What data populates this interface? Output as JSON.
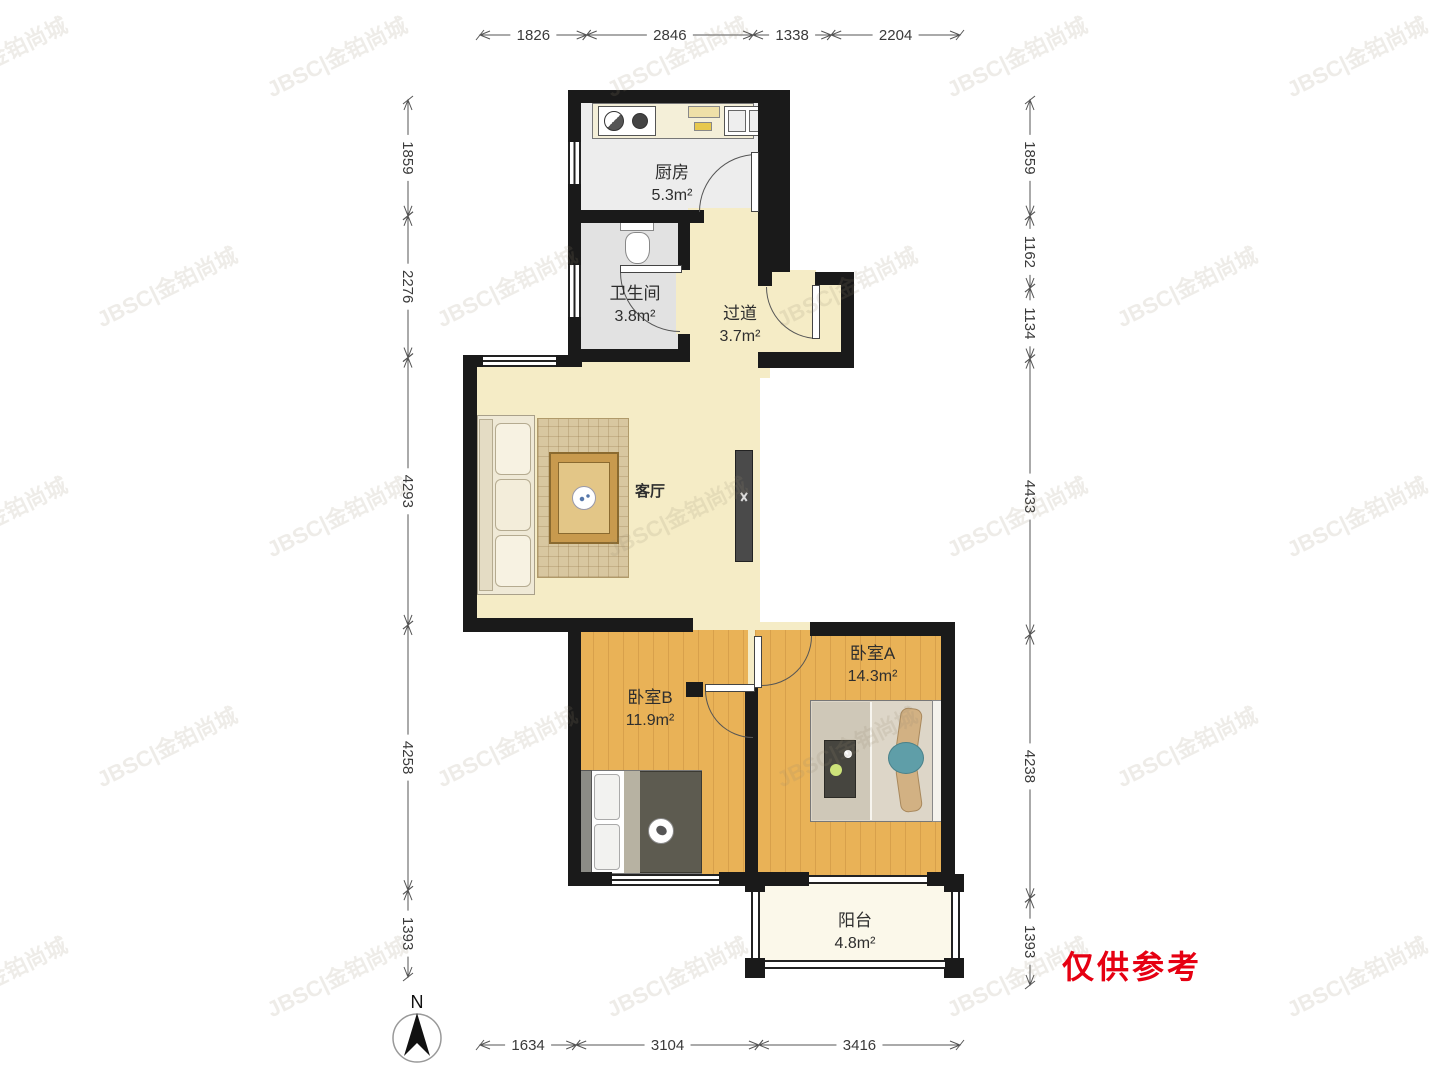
{
  "watermark": "JBSC|金铂尚城",
  "disclaimer": "仅供参考",
  "compass_label": "N",
  "rooms": {
    "kitchen": {
      "name": "厨房",
      "area": "5.3m²"
    },
    "bathroom": {
      "name": "卫生间",
      "area": "3.8m²"
    },
    "hallway": {
      "name": "过道",
      "area": "3.7m²"
    },
    "living": {
      "name": "客厅",
      "area": ""
    },
    "bedroom_a": {
      "name": "卧室A",
      "area": "14.3m²"
    },
    "bedroom_b": {
      "name": "卧室B",
      "area": "11.9m²"
    },
    "balcony": {
      "name": "阳台",
      "area": "4.8m²"
    }
  },
  "dimensions_mm": {
    "top": [
      1826,
      2846,
      1338,
      2204
    ],
    "left": [
      1859,
      2276,
      4293,
      4258,
      1393
    ],
    "right": [
      1859,
      1162,
      1134,
      4433,
      4238,
      1393
    ],
    "bottom": [
      1634,
      3104,
      3416
    ]
  },
  "colors": {
    "wall": "#1a1a1a",
    "floor_main": "#f5ecc6",
    "floor_wood": "#e9b257",
    "floor_tile": "#ededed",
    "floor_balcony": "#fbf8ea",
    "dimension_text": "#3a3a3a",
    "disclaimer_red": "#e60012"
  }
}
